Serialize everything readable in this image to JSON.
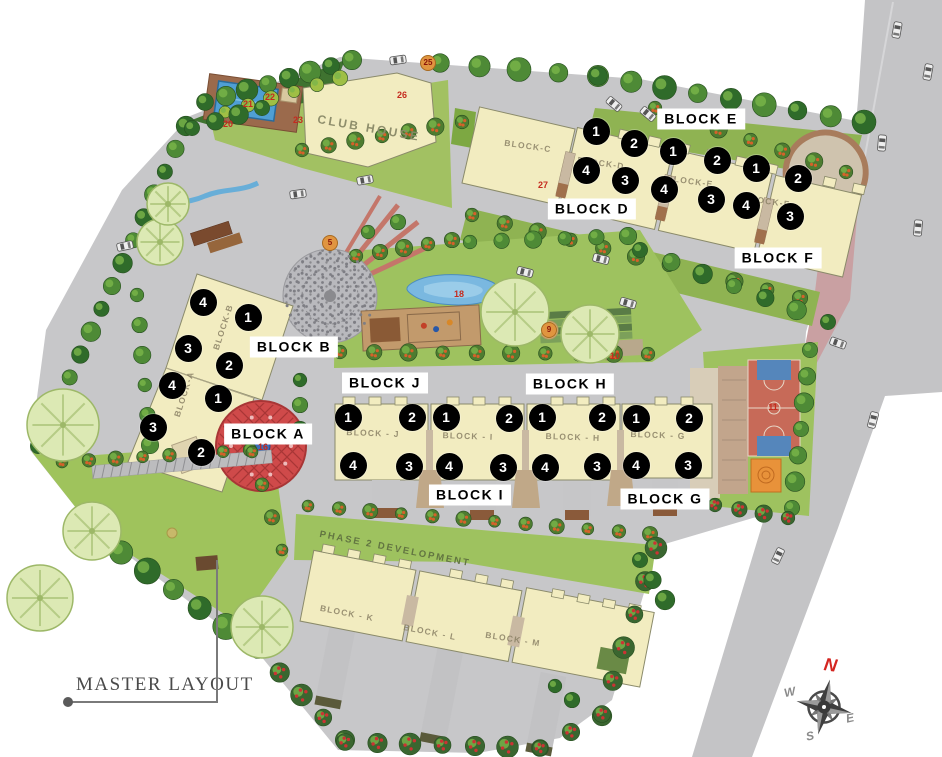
{
  "legend": {
    "title": "MASTER LAYOUT"
  },
  "compass": {
    "north": "N",
    "east": "E",
    "south": "S",
    "west": "W"
  },
  "block_labels": [
    {
      "id": "block-e",
      "text": "BLOCK E",
      "x": 701,
      "y": 119
    },
    {
      "id": "block-d",
      "text": "BLOCK D",
      "x": 592,
      "y": 209
    },
    {
      "id": "block-f",
      "text": "BLOCK F",
      "x": 778,
      "y": 258
    },
    {
      "id": "block-b",
      "text": "BLOCK B",
      "x": 294,
      "y": 347
    },
    {
      "id": "block-a",
      "text": "BLOCK A",
      "x": 268,
      "y": 434
    },
    {
      "id": "block-j",
      "text": "BLOCK J",
      "x": 385,
      "y": 383
    },
    {
      "id": "block-h",
      "text": "BLOCK H",
      "x": 570,
      "y": 384
    },
    {
      "id": "block-i",
      "text": "BLOCK I",
      "x": 470,
      "y": 495
    },
    {
      "id": "block-g",
      "text": "BLOCK G",
      "x": 665,
      "y": 499
    }
  ],
  "building_tags": [
    {
      "text": "BLOCK-C",
      "x": 528,
      "y": 146,
      "rot": 8,
      "kind": "name"
    },
    {
      "text": "BLOCK-D",
      "x": 601,
      "y": 163,
      "rot": 8,
      "kind": "name"
    },
    {
      "text": "BLOCK-E",
      "x": 690,
      "y": 181,
      "rot": 8,
      "kind": "name"
    },
    {
      "text": "BLOCK-F",
      "x": 767,
      "y": 201,
      "rot": 8,
      "kind": "name"
    },
    {
      "text": "BLOCK-B",
      "x": 223,
      "y": 327,
      "rot": -72,
      "kind": "name"
    },
    {
      "text": "BLOCK-A",
      "x": 184,
      "y": 394,
      "rot": -72,
      "kind": "name"
    },
    {
      "text": "BLOCK - J",
      "x": 373,
      "y": 433,
      "rot": 2,
      "kind": "name"
    },
    {
      "text": "BLOCK - I",
      "x": 468,
      "y": 436,
      "rot": 2,
      "kind": "name"
    },
    {
      "text": "BLOCK - H",
      "x": 573,
      "y": 437,
      "rot": 2,
      "kind": "name"
    },
    {
      "text": "BLOCK - G",
      "x": 658,
      "y": 435,
      "rot": 2,
      "kind": "name"
    },
    {
      "text": "BLOCK - K",
      "x": 347,
      "y": 613,
      "rot": 11,
      "kind": "name"
    },
    {
      "text": "BLOCK - L",
      "x": 430,
      "y": 632,
      "rot": 11,
      "kind": "name"
    },
    {
      "text": "BLOCK - M",
      "x": 513,
      "y": 639,
      "rot": 9,
      "kind": "name"
    },
    {
      "text": "CLUB HOUSE",
      "x": 369,
      "y": 128,
      "rot": 10,
      "kind": "club"
    },
    {
      "text": "PHASE 2 DEVELOPMENT",
      "x": 395,
      "y": 549,
      "rot": 11,
      "kind": "phase"
    }
  ],
  "unit_markers": [
    {
      "block": "D",
      "n": "1",
      "x": 596,
      "y": 131
    },
    {
      "block": "D",
      "n": "2",
      "x": 634,
      "y": 143
    },
    {
      "block": "D",
      "n": "4",
      "x": 586,
      "y": 170
    },
    {
      "block": "D",
      "n": "3",
      "x": 625,
      "y": 180
    },
    {
      "block": "E",
      "n": "1",
      "x": 673,
      "y": 151
    },
    {
      "block": "E",
      "n": "2",
      "x": 717,
      "y": 160
    },
    {
      "block": "E",
      "n": "4",
      "x": 664,
      "y": 189
    },
    {
      "block": "E",
      "n": "3",
      "x": 711,
      "y": 199
    },
    {
      "block": "F",
      "n": "1",
      "x": 756,
      "y": 168
    },
    {
      "block": "F",
      "n": "2",
      "x": 798,
      "y": 178
    },
    {
      "block": "F",
      "n": "4",
      "x": 746,
      "y": 205
    },
    {
      "block": "F",
      "n": "3",
      "x": 790,
      "y": 216
    },
    {
      "block": "B",
      "n": "4",
      "x": 203,
      "y": 302
    },
    {
      "block": "B",
      "n": "1",
      "x": 248,
      "y": 317
    },
    {
      "block": "B",
      "n": "3",
      "x": 188,
      "y": 348
    },
    {
      "block": "B",
      "n": "2",
      "x": 229,
      "y": 365
    },
    {
      "block": "A",
      "n": "4",
      "x": 172,
      "y": 385
    },
    {
      "block": "A",
      "n": "1",
      "x": 218,
      "y": 398
    },
    {
      "block": "A",
      "n": "3",
      "x": 153,
      "y": 427
    },
    {
      "block": "A",
      "n": "2",
      "x": 201,
      "y": 452
    },
    {
      "block": "J",
      "n": "1",
      "x": 348,
      "y": 417
    },
    {
      "block": "J",
      "n": "2",
      "x": 412,
      "y": 417
    },
    {
      "block": "J",
      "n": "4",
      "x": 353,
      "y": 465
    },
    {
      "block": "J",
      "n": "3",
      "x": 409,
      "y": 466
    },
    {
      "block": "I",
      "n": "1",
      "x": 446,
      "y": 417
    },
    {
      "block": "I",
      "n": "2",
      "x": 509,
      "y": 418
    },
    {
      "block": "I",
      "n": "4",
      "x": 449,
      "y": 466
    },
    {
      "block": "I",
      "n": "3",
      "x": 503,
      "y": 467
    },
    {
      "block": "H",
      "n": "1",
      "x": 542,
      "y": 417
    },
    {
      "block": "H",
      "n": "2",
      "x": 602,
      "y": 417
    },
    {
      "block": "H",
      "n": "4",
      "x": 545,
      "y": 467
    },
    {
      "block": "H",
      "n": "3",
      "x": 597,
      "y": 466
    },
    {
      "block": "G",
      "n": "1",
      "x": 636,
      "y": 418
    },
    {
      "block": "G",
      "n": "2",
      "x": 689,
      "y": 418
    },
    {
      "block": "G",
      "n": "4",
      "x": 636,
      "y": 465
    },
    {
      "block": "G",
      "n": "3",
      "x": 688,
      "y": 465
    }
  ],
  "site_numbers": [
    {
      "n": "5",
      "x": 330,
      "y": 243,
      "circled": true
    },
    {
      "n": "9",
      "x": 549,
      "y": 330,
      "circled": true
    },
    {
      "n": "10",
      "x": 615,
      "y": 356,
      "circled": false
    },
    {
      "n": "11",
      "x": 773,
      "y": 407,
      "circled": false
    },
    {
      "n": "16",
      "x": 263,
      "y": 447,
      "circled": false
    },
    {
      "n": "18",
      "x": 459,
      "y": 294,
      "circled": false
    },
    {
      "n": "20",
      "x": 228,
      "y": 124,
      "circled": false
    },
    {
      "n": "21",
      "x": 248,
      "y": 104,
      "circled": false
    },
    {
      "n": "22",
      "x": 270,
      "y": 97,
      "circled": false
    },
    {
      "n": "23",
      "x": 298,
      "y": 120,
      "circled": false
    },
    {
      "n": "25",
      "x": 428,
      "y": 63,
      "circled": true
    },
    {
      "n": "26",
      "x": 402,
      "y": 95,
      "circled": false
    },
    {
      "n": "27",
      "x": 543,
      "y": 185,
      "circled": false
    }
  ],
  "colors": {
    "road": "#c7c7c9",
    "lawn": "#9ec25f",
    "building": "#f2ecc0",
    "marker": "#000000",
    "north": "#d42520",
    "pool": "#4f9fd4",
    "court": "#c76a58",
    "mandala": "#cf4a4a"
  }
}
